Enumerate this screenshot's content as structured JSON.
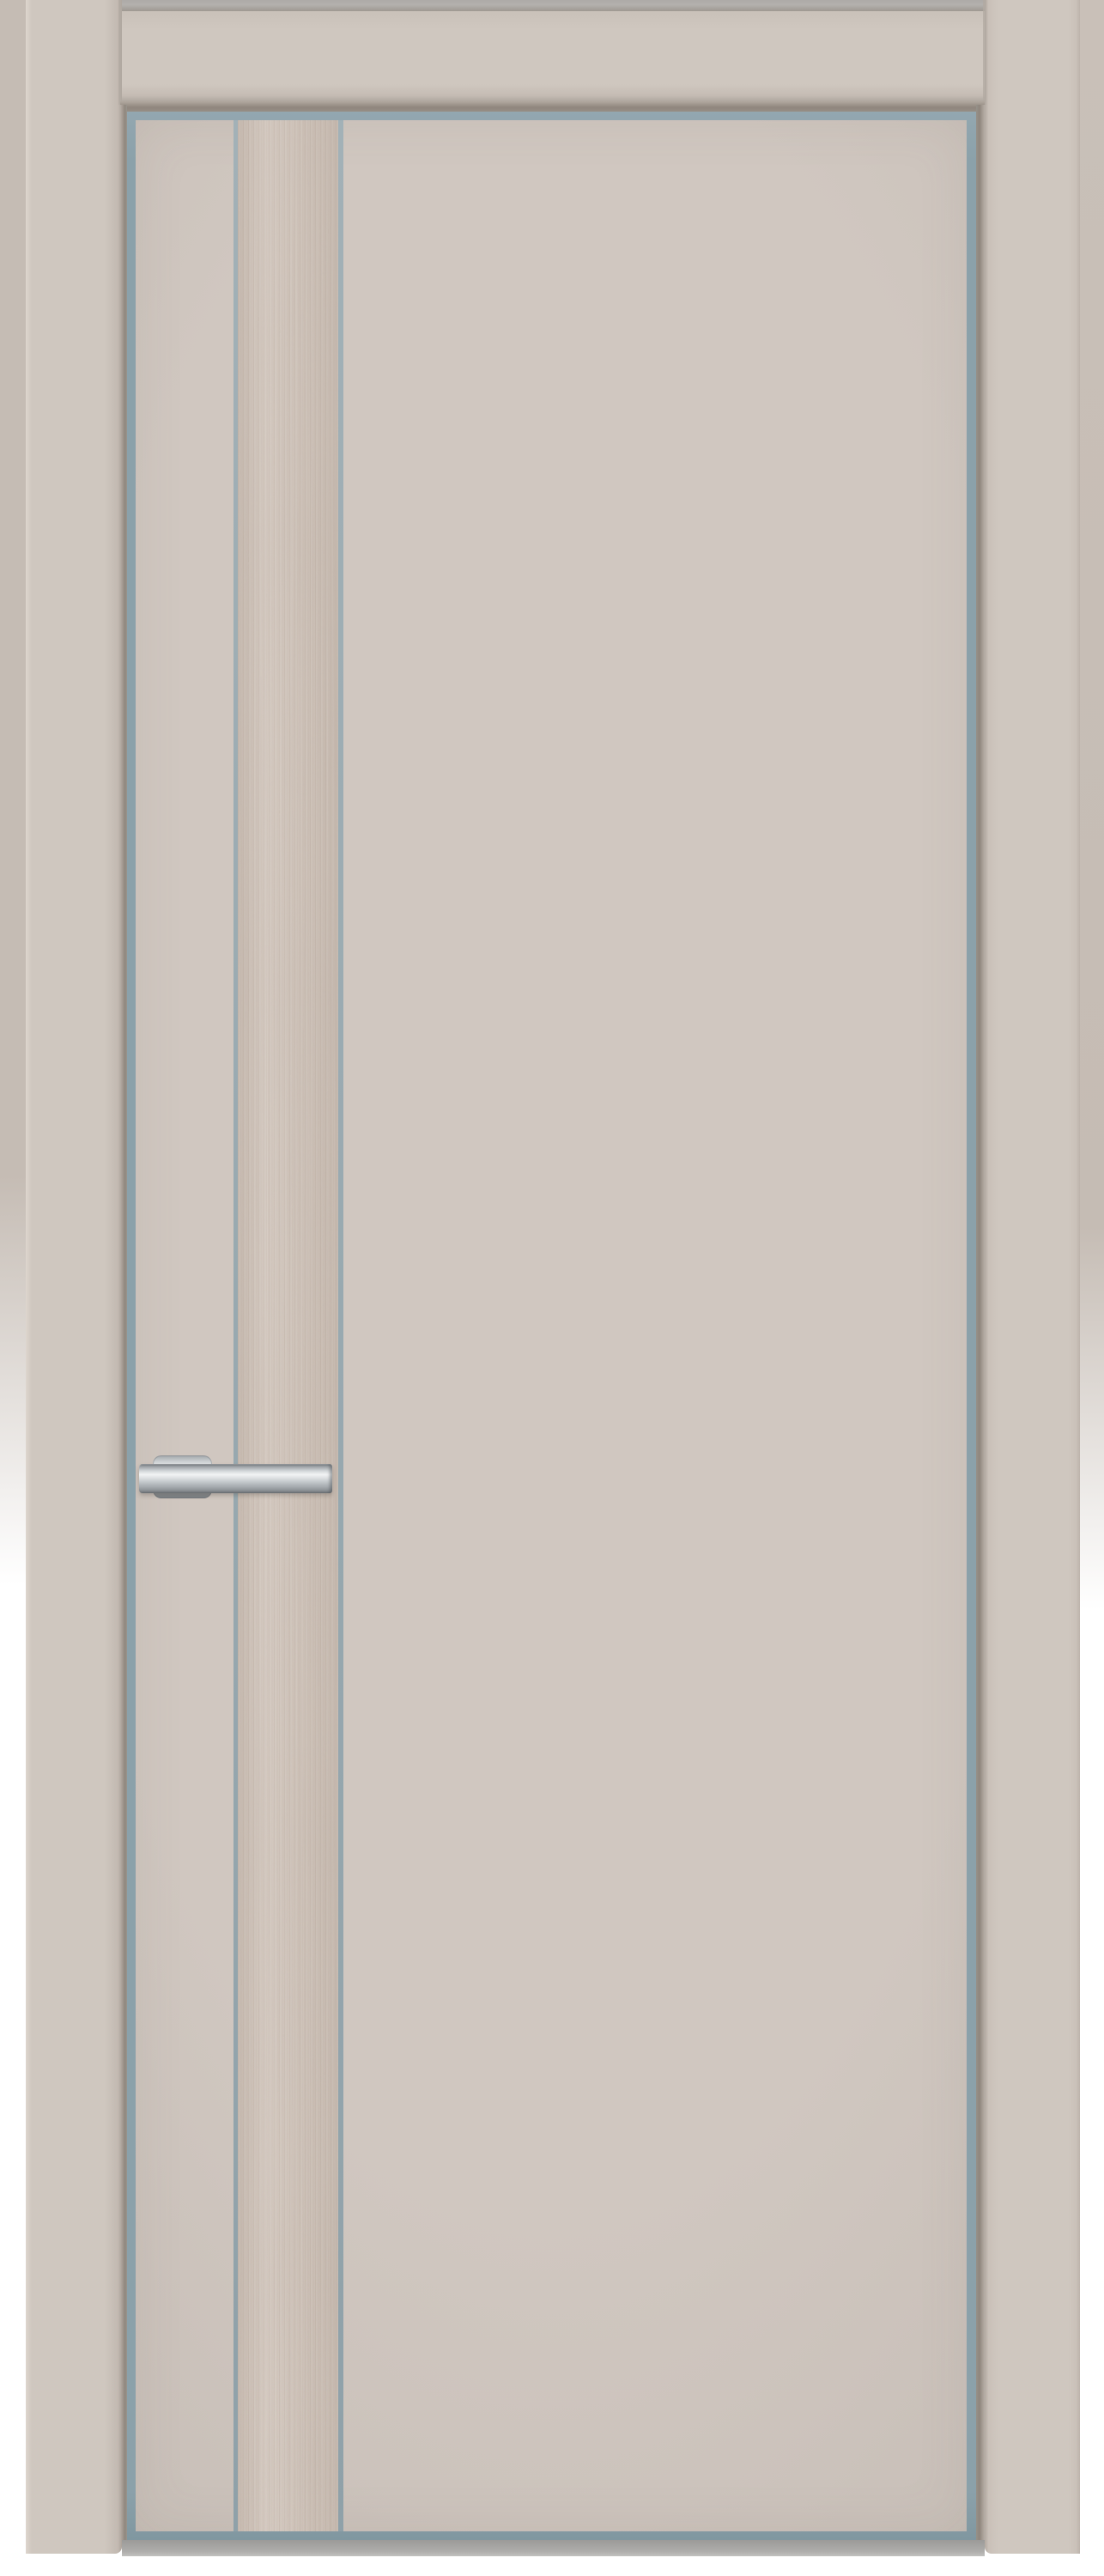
{
  "scene": {
    "type": "product-photo",
    "subject": "closed interior flush door with frame",
    "details": {
      "door_finish": "matte cashmere beige",
      "insert": "vertical light wood veneer strip near hinge side",
      "edging": "blue-gray aluminum edge around door slab and insert",
      "hardware": "brushed stainless steel lever handle on round-cornered rosette, pointing right",
      "frame": "matching beige architrave casings, head casing between side casings",
      "backdrop": "wall fading to white toward bottom, white margin below door, gray floor shadow band"
    }
  },
  "palette": {
    "background_white": "#ffffff",
    "wall_beige": "#c5bcb4",
    "wall_top_gray": "#b3b0ad",
    "casing_beige": "#cfc7bf",
    "casing_highlight": "#ded6ce",
    "reveal_shadow": "#8f867d",
    "aluminum_edge": "#8ba1aa",
    "aluminum_thin_line": "#98a9b0",
    "panel_beige": "#d0c7c0",
    "panel_edge_beige": "#c5bcb5",
    "wood_base": "#cbbfb6",
    "wood_grain_dark": "#b2a59b",
    "wood_grain_light": "#ddd2c9",
    "handle_silver_light": "#f1f3f4",
    "handle_silver_mid": "#c2c7ca",
    "handle_silver_dark": "#777c80",
    "floor_shadow_gray": "#9b9a98"
  }
}
